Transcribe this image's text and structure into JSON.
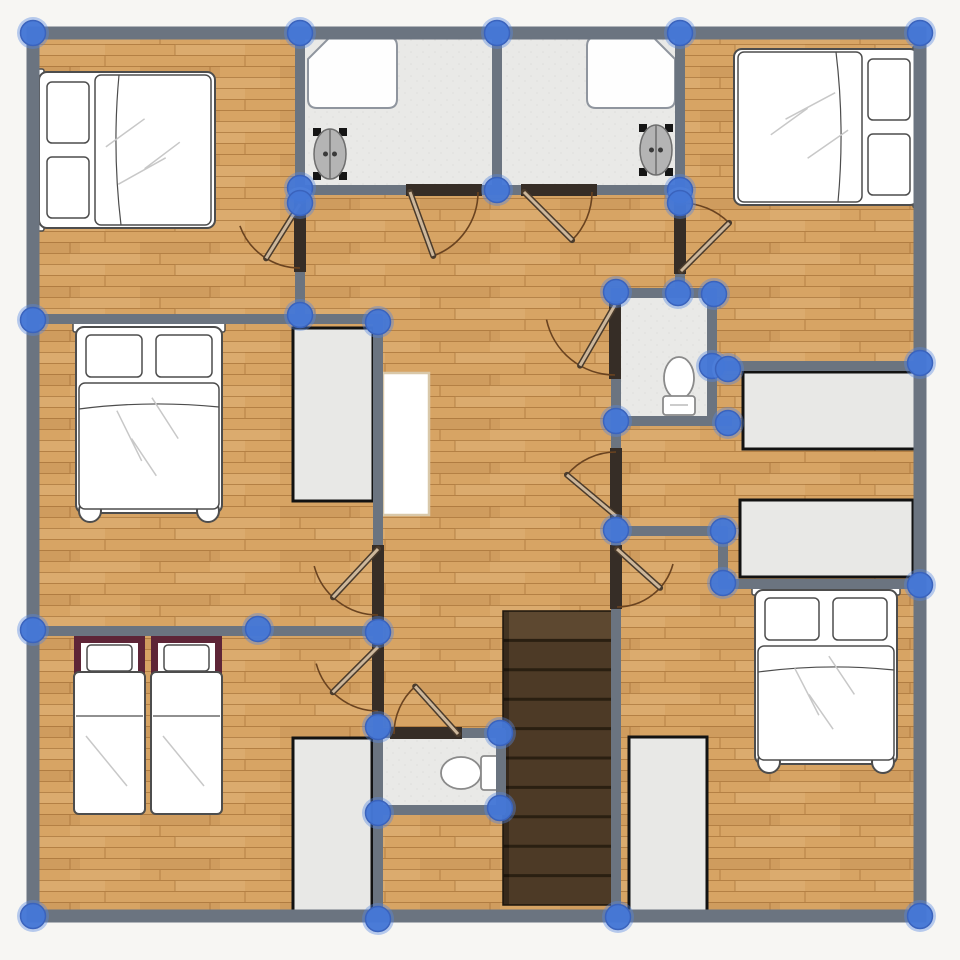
{
  "canvas": {
    "width": 960,
    "height": 960
  },
  "colors": {
    "outside": "#f7f6f3",
    "wall": "#6b7480",
    "jamb": "#362d26",
    "node": "#4577d6",
    "node_ring": "rgba(85,135,225,0.40)",
    "node_stroke": "#3a63bd",
    "wood_base": "#d7a464",
    "wood_grain": "rgba(138,85,28,0.45)",
    "wood_light": "rgba(255,235,200,0.10)",
    "wood_dark": "rgba(100,60,15,0.07)",
    "tile": "#e9e9e7",
    "tile_speck": "rgba(0,0,0,0.05)",
    "stair_base": "#4d3a26",
    "stair_line": "#2a1f11",
    "stair_top": "#5d4830",
    "stair_edge": "rgba(0,0,0,0.28)",
    "wardrobe_fill": "#e8e8e6",
    "wardrobe_stroke": "#121212",
    "shelf_fill": "#ffffff",
    "shelf_stroke": "#d9c8a9",
    "furniture_stroke": "#4d4d4d",
    "crease": "#c8c8c8",
    "white": "#ffffff",
    "tub_fill": "#fefefe",
    "tub_stroke": "#8f959e",
    "sink_fill": "#b4b4b4",
    "sink_stroke": "#6e6e6e",
    "sink_frame": "#151515",
    "toilet_stroke": "#8a8a8a",
    "maroon": "#5e2537",
    "door_leaf": "#cdb79b",
    "door_leaf_edge": "#4a3b2c",
    "door_arc": "#6a4320"
  },
  "floor": {
    "x": 33,
    "y": 33,
    "w": 887,
    "h": 883
  },
  "tile_floors": [
    [
      305,
      36,
      372,
      150
    ],
    [
      620,
      297,
      88,
      120
    ],
    [
      382,
      737,
      120,
      70
    ]
  ],
  "outer_thickness": 13,
  "outer_walls": [
    [
      27,
      33,
      926,
      33
    ],
    [
      33,
      27,
      33,
      922
    ],
    [
      27,
      916,
      926,
      916
    ],
    [
      920,
      27,
      920,
      922
    ]
  ],
  "inner_thickness": 10,
  "inner_walls": [
    [
      300,
      38,
      300,
      202
    ],
    [
      300,
      270,
      300,
      320
    ],
    [
      497,
      38,
      497,
      192
    ],
    [
      680,
      38,
      680,
      198
    ],
    [
      680,
      272,
      680,
      298
    ],
    [
      295,
      190,
      408,
      190
    ],
    [
      480,
      190,
      523,
      190
    ],
    [
      595,
      190,
      684,
      190
    ],
    [
      28,
      319,
      382,
      319
    ],
    [
      378,
      315,
      378,
      547
    ],
    [
      378,
      612,
      378,
      650
    ],
    [
      378,
      713,
      378,
      916
    ],
    [
      28,
      631,
      382,
      631
    ],
    [
      616,
      288,
      616,
      303
    ],
    [
      616,
      375,
      616,
      450
    ],
    [
      616,
      513,
      616,
      547
    ],
    [
      616,
      603,
      616,
      916
    ],
    [
      611,
      293,
      716,
      293
    ],
    [
      712,
      289,
      712,
      424
    ],
    [
      611,
      421,
      732,
      421
    ],
    [
      708,
      366,
      924,
      366
    ],
    [
      611,
      531,
      727,
      531
    ],
    [
      723,
      527,
      723,
      587
    ],
    [
      719,
      584,
      924,
      584
    ],
    [
      373,
      733,
      392,
      733
    ],
    [
      458,
      733,
      505,
      733
    ],
    [
      376,
      810,
      505,
      810
    ],
    [
      501,
      730,
      501,
      813
    ]
  ],
  "jambs": [
    [
      294,
      200,
      12,
      72
    ],
    [
      674,
      196,
      12,
      78
    ],
    [
      406,
      184,
      76,
      12
    ],
    [
      521,
      184,
      76,
      12
    ],
    [
      609,
      301,
      12,
      78
    ],
    [
      610,
      448,
      12,
      71
    ],
    [
      610,
      545,
      12,
      64
    ],
    [
      372,
      545,
      12,
      75
    ],
    [
      372,
      643,
      12,
      74
    ],
    [
      390,
      727,
      72,
      12
    ]
  ],
  "doors": [
    {
      "hinge": [
        410,
        192
      ],
      "r": 68,
      "arc": [
        0,
        70
      ],
      "leaf": 70
    },
    {
      "hinge": [
        524,
        192
      ],
      "r": 68,
      "arc": [
        0,
        45
      ],
      "leaf": 45
    },
    {
      "hinge": [
        300,
        204
      ],
      "r": 64,
      "arc": [
        90,
        160
      ],
      "leaf": 122
    },
    {
      "hinge": [
        681,
        271
      ],
      "r": 68,
      "arc": [
        -90,
        -45
      ],
      "leaf": -45
    },
    {
      "hinge": [
        615,
        305
      ],
      "r": 70,
      "arc": [
        90,
        168
      ],
      "leaf": 120
    },
    {
      "hinge": [
        616,
        516
      ],
      "r": 64,
      "arc": [
        -90,
        -140
      ],
      "leaf": -140
    },
    {
      "hinge": [
        617,
        549
      ],
      "r": 58,
      "arc": [
        15,
        90
      ],
      "leaf": 42
    },
    {
      "hinge": [
        378,
        549
      ],
      "r": 66,
      "arc": [
        90,
        165
      ],
      "leaf": 133
    },
    {
      "hinge": [
        378,
        647
      ],
      "r": 64,
      "arc": [
        90,
        165
      ],
      "leaf": 135
    },
    {
      "hinge": [
        458,
        734
      ],
      "r": 64,
      "arc": [
        180,
        228
      ],
      "leaf": 228
    }
  ],
  "node_radius": 12.5,
  "nodes": [
    [
      33,
      33
    ],
    [
      300,
      33
    ],
    [
      497,
      33
    ],
    [
      680,
      33
    ],
    [
      920,
      33
    ],
    [
      33,
      320
    ],
    [
      33,
      630
    ],
    [
      33,
      916
    ],
    [
      378,
      919
    ],
    [
      618,
      917
    ],
    [
      920,
      916
    ],
    [
      920,
      363
    ],
    [
      920,
      585
    ],
    [
      300,
      188
    ],
    [
      300,
      203
    ],
    [
      497,
      190
    ],
    [
      680,
      190
    ],
    [
      680,
      203
    ],
    [
      300,
      315
    ],
    [
      378,
      322
    ],
    [
      258,
      629
    ],
    [
      378,
      632
    ],
    [
      378,
      727
    ],
    [
      378,
      813
    ],
    [
      500,
      733
    ],
    [
      500,
      808
    ],
    [
      616,
      292
    ],
    [
      678,
      293
    ],
    [
      714,
      294
    ],
    [
      712,
      366
    ],
    [
      728,
      369
    ],
    [
      616,
      421
    ],
    [
      728,
      423
    ],
    [
      616,
      530
    ],
    [
      723,
      531
    ],
    [
      723,
      583
    ]
  ],
  "beds": [
    {
      "cx": 127,
      "cy": 150,
      "w": 156,
      "l": 176,
      "rot": -90,
      "type": "double",
      "feet": false
    },
    {
      "cx": 826,
      "cy": 127,
      "w": 156,
      "l": 184,
      "rot": 90,
      "type": "double",
      "feet": false
    },
    {
      "cx": 149,
      "cy": 420,
      "w": 146,
      "l": 186,
      "rot": 0,
      "type": "double",
      "feet": true
    },
    {
      "cx": 826,
      "cy": 677,
      "w": 142,
      "l": 174,
      "rot": 0,
      "type": "double",
      "feet": true
    },
    {
      "cx": 148,
      "cy": 725,
      "w": 148,
      "l": 178,
      "rot": 0,
      "type": "twin",
      "feet": false
    }
  ],
  "wardrobes": [
    [
      293,
      328,
      80,
      173
    ],
    [
      743,
      372,
      174,
      77
    ],
    [
      740,
      500,
      173,
      77
    ],
    [
      629,
      737,
      78,
      175
    ],
    [
      293,
      738,
      79,
      175
    ]
  ],
  "shelves": [
    [
      383,
      373,
      46,
      142
    ]
  ],
  "bathtubs": [
    {
      "x": 308,
      "y": 37,
      "w": 89,
      "h": 71,
      "cut": "tl"
    },
    {
      "x": 587,
      "y": 37,
      "w": 88,
      "h": 71,
      "cut": "tr"
    }
  ],
  "sinks": [
    {
      "cx": 330,
      "cy": 154
    },
    {
      "cx": 656,
      "cy": 150
    }
  ],
  "toilets": [
    {
      "cx": 679,
      "cy": 385,
      "dir": "up"
    },
    {
      "cx": 470,
      "cy": 773,
      "dir": "left"
    }
  ],
  "stairs": {
    "x": 503,
    "y": 611,
    "w": 110,
    "h": 294,
    "treads": 10
  }
}
